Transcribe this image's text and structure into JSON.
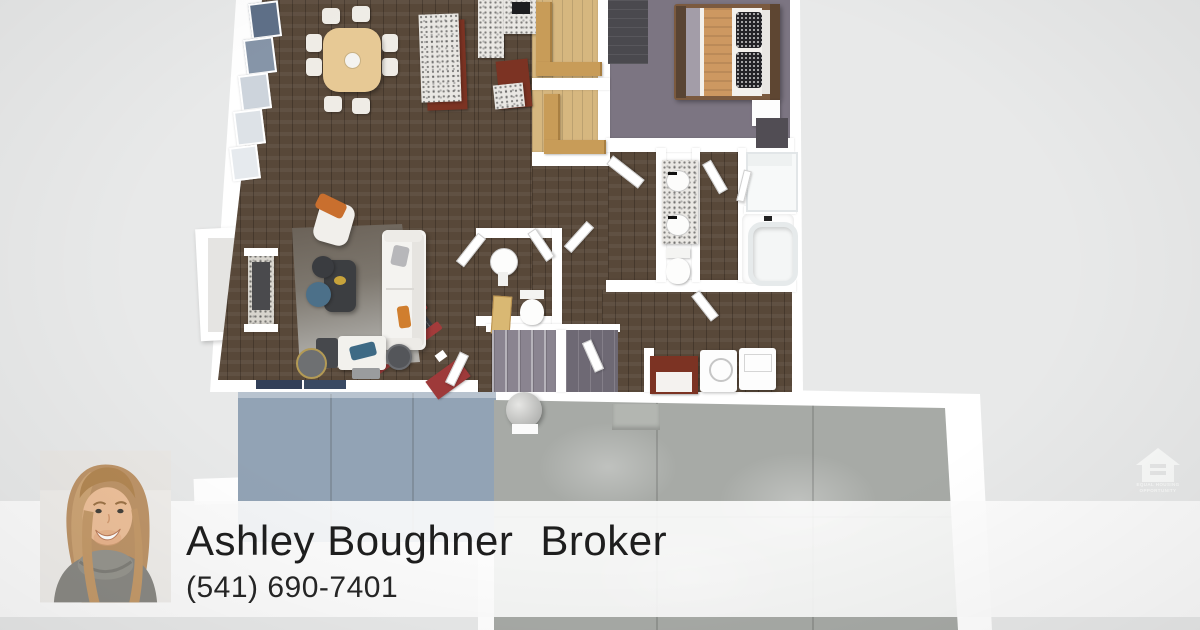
{
  "agent": {
    "name": "Ashley Boughner",
    "title": "Broker",
    "phone": "(541) 690-7401"
  },
  "equal_housing_logo": {
    "line1": "EQUAL HOUSING",
    "line2": "OPPORTUNITY"
  },
  "floorplan": {
    "kind": "3d-overhead-floorplan-render",
    "visible_rooms": [
      "dining-room",
      "kitchen",
      "pantry",
      "bedroom",
      "master-bathroom",
      "powder-room",
      "living-room",
      "hallway",
      "stairs",
      "laundry",
      "garage",
      "deck",
      "porch"
    ]
  },
  "theme": {
    "colors": {
      "bg": "#e8e9e9",
      "wall": "#ffffff",
      "wood": "#584839",
      "oak-floor": "#d6b77f",
      "carpet": "#7c7582",
      "concrete": "#a7aaa6",
      "deck": "#92a3b5",
      "granite": "#e9e7e3",
      "cherry": "#7c3323",
      "red-rail": "#a33b3b",
      "bar": "rgba(253,253,253,0.9)",
      "text": "#1e1e1e"
    }
  }
}
